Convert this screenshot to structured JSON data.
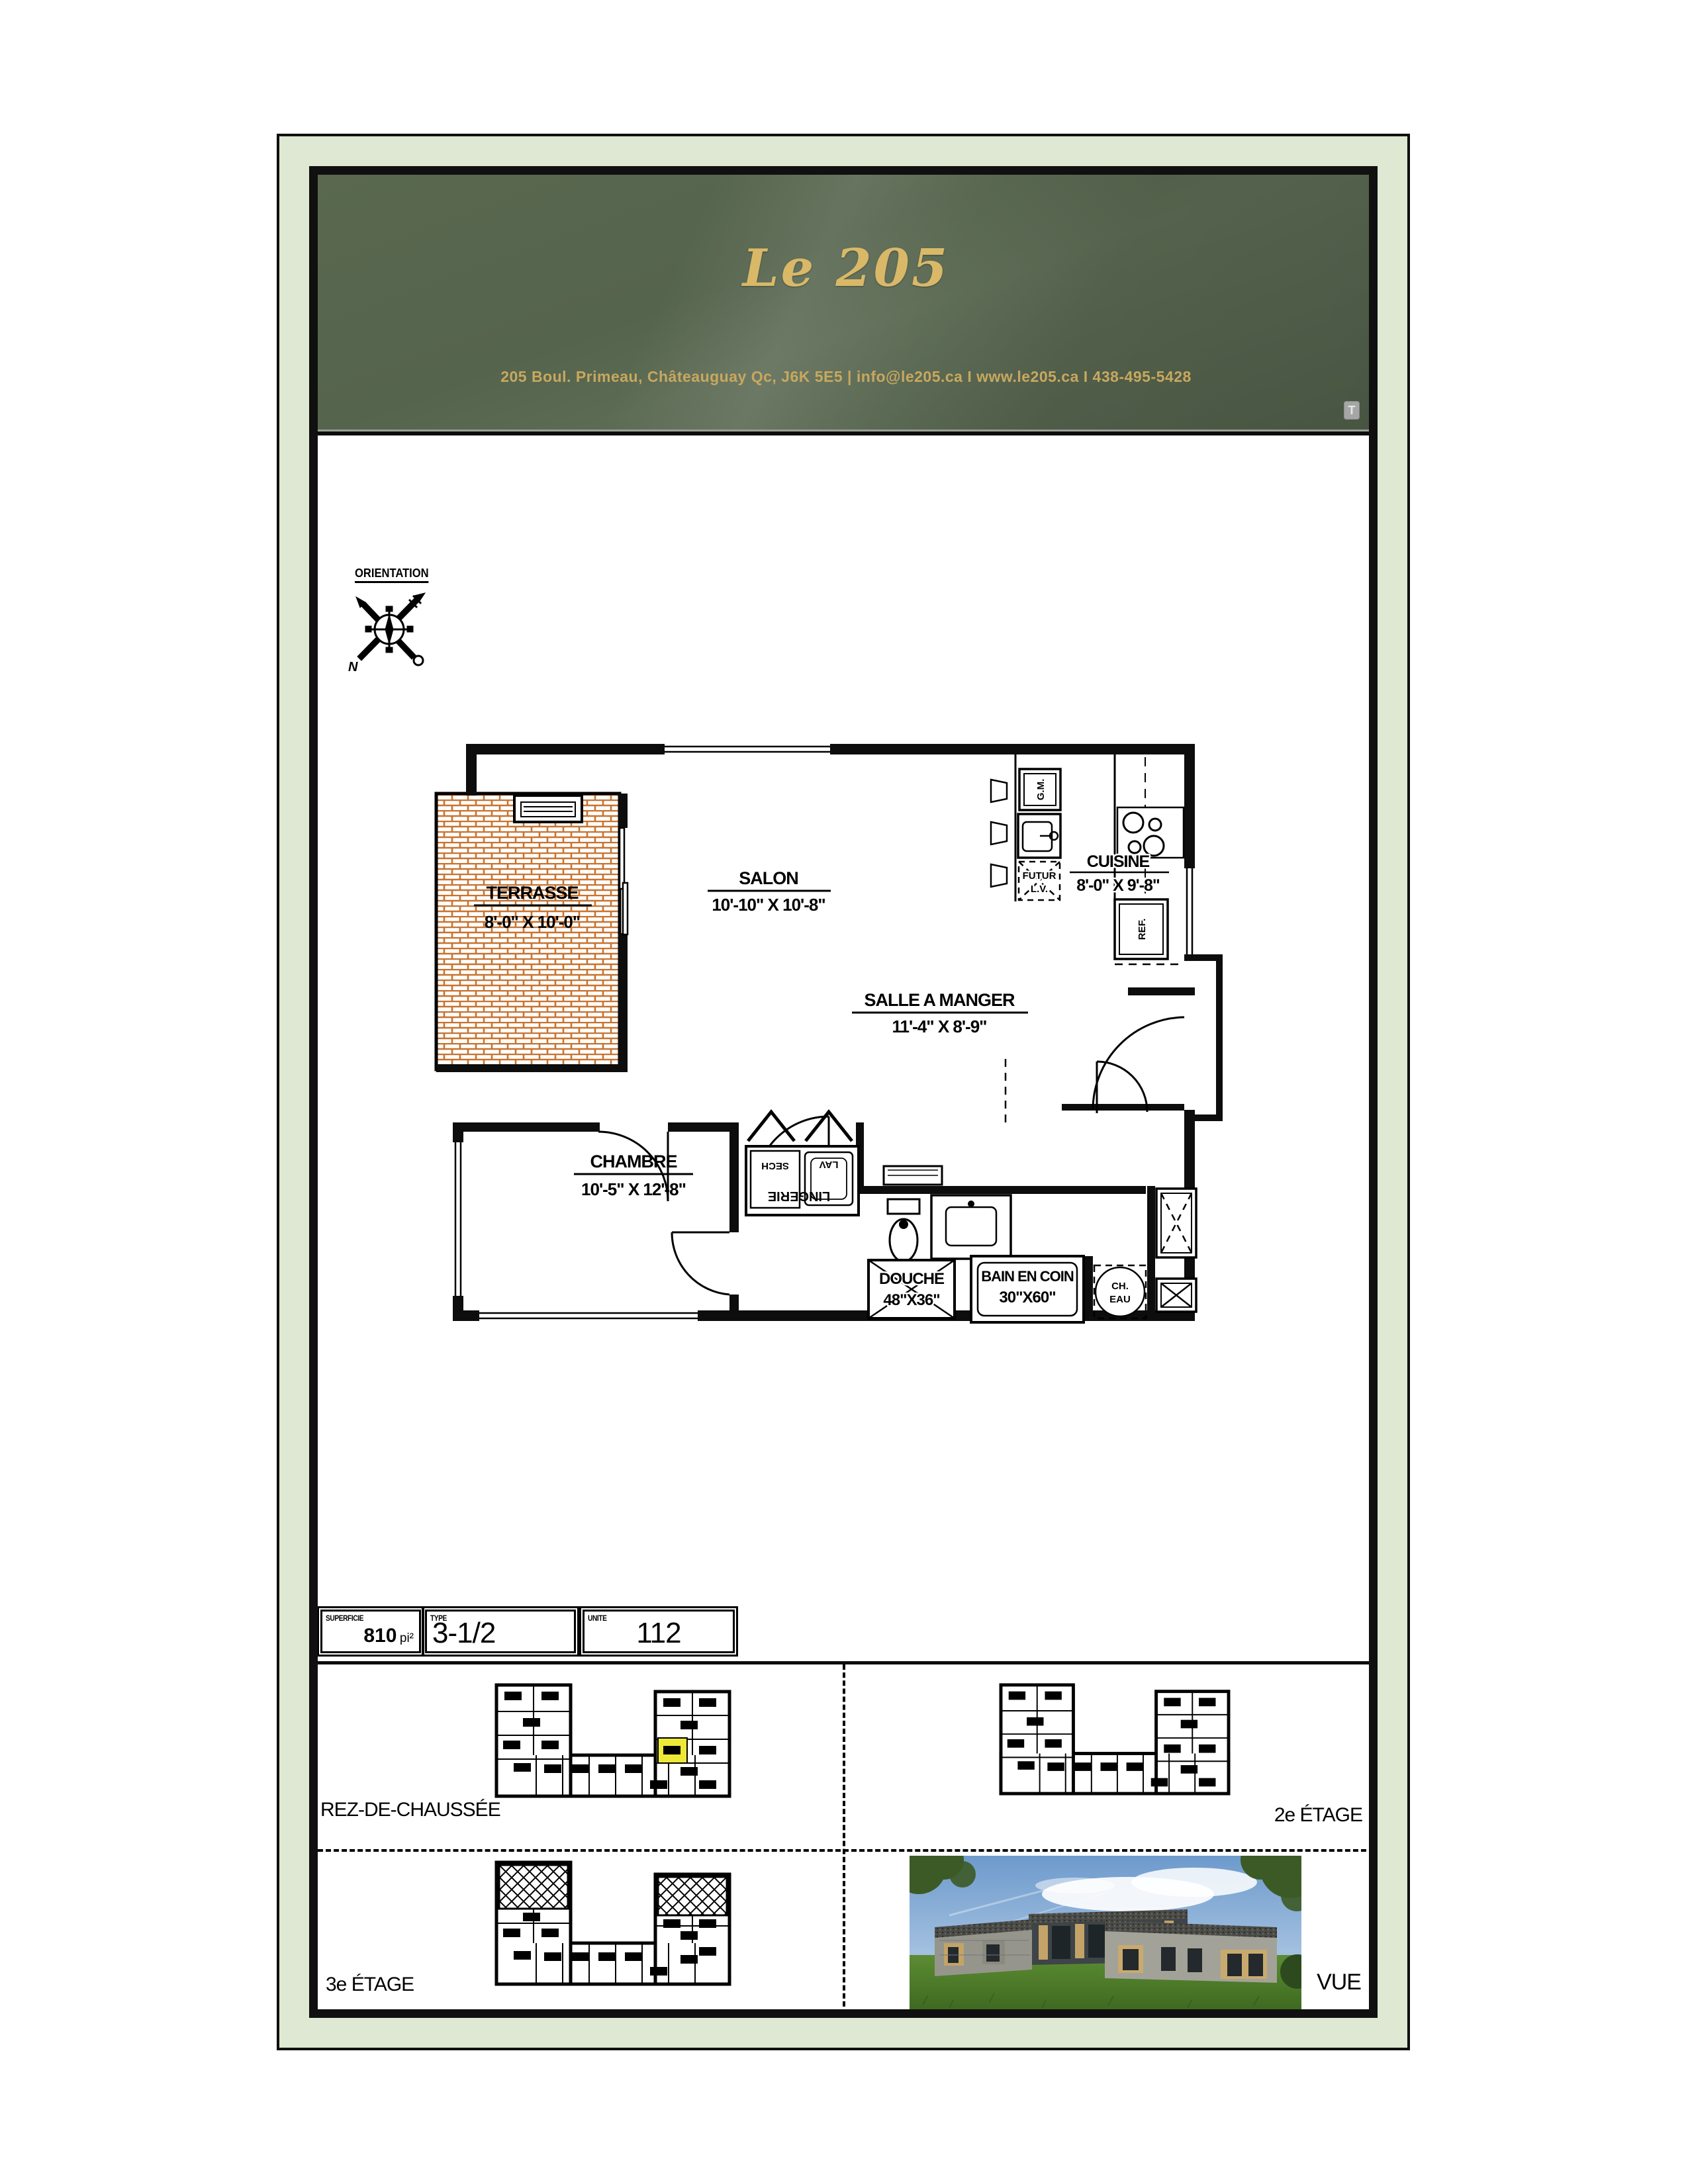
{
  "header": {
    "logo": "Le 205",
    "address": "205 Boul. Primeau, Châteauguay Qc, J6K 5E5   |   info@le205.ca   I   www.le205.ca   I   438-495-5428",
    "annotation_icon": "T"
  },
  "orientation": {
    "label": "ORIENTATION",
    "north": "N"
  },
  "plan": {
    "rooms": [
      {
        "name": "TERRASSE",
        "dim": "8'-0\" X 10'-0\""
      },
      {
        "name": "SALON",
        "dim": "10'-10\" X 10'-8\""
      },
      {
        "name": "CUISINE",
        "dim": "8'-0\" X 9'-8\""
      },
      {
        "name": "SALLE A MANGER",
        "dim": "11'-4\" X 8'-9\""
      },
      {
        "name": "CHAMBRE",
        "dim": "10'-5\" X 12'-8\""
      }
    ],
    "fixtures": {
      "gm": "G.M.",
      "futur_line1": "FUTUR",
      "futur_line2": "L.V.",
      "ref": "REF.",
      "sech": "SECH",
      "lav": "LAV",
      "lingerie": "LINGERIE",
      "douche_name": "DOUCHE",
      "douche_dim": "48\"X36\"",
      "bain_name": "BAIN EN COIN",
      "bain_dim": "30\"X60\"",
      "ch_eau_line1": "CH.",
      "ch_eau_line2": "EAU"
    }
  },
  "info_bar": {
    "superficie_label": "SUPERFICIE",
    "superficie_value": "810",
    "superficie_unit": "pi²",
    "type_label": "TYPE",
    "type_value": "3-1/2",
    "unite_label": "UNITE",
    "unite_value": "112"
  },
  "floors": {
    "rez": "REZ-DE-CHAUSSÉE",
    "e2": "2e ÉTAGE",
    "e3": "3e ÉTAGE",
    "vue": "VUE"
  },
  "colors": {
    "frame_green": "#dee8d2",
    "header_green": "#55644d",
    "gold": "#d9b868",
    "brick_orange": "#c8732f",
    "unit_highlight": "#ede838"
  }
}
